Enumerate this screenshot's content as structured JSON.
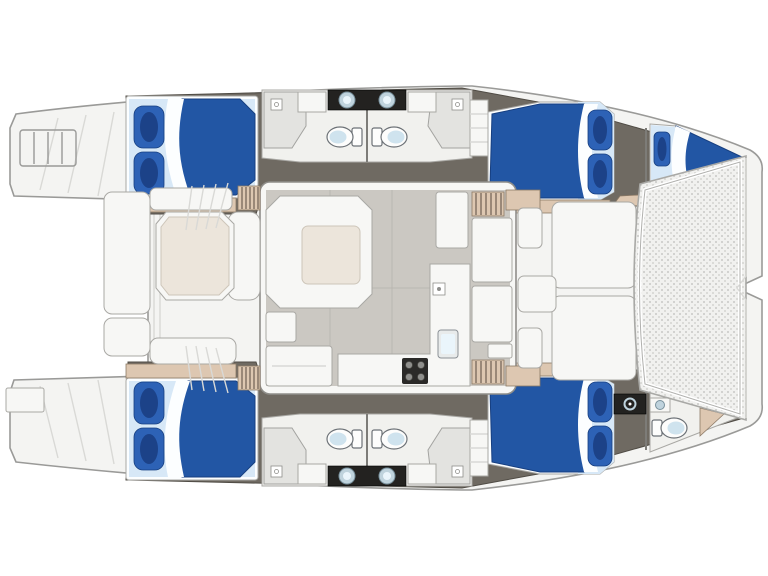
{
  "diagram": {
    "kind": "yacht-deck-plan",
    "subject": "sailing catamaran interior layout, top view, bow to the right",
    "areas": [
      "stern-swim-platforms",
      "aft-cockpit-with-table",
      "salon-with-galley-and-sofa",
      "port-hull-aft-double-cabin",
      "port-hull-bathrooms",
      "port-hull-forward-double-cabin",
      "port-forepeak-berth",
      "starboard-hull-aft-double-cabin",
      "starboard-hull-bathrooms",
      "starboard-hull-forward-double-cabin",
      "starboard-forepeak-head",
      "forward-cockpit",
      "bow-trampoline"
    ]
  },
  "colors": {
    "paper": "#ffffff",
    "deck": "#f4f4f2",
    "deck_line": "#9a9a98",
    "deck_seam": "#d9d9d6",
    "hull_floor": "#6f6a62",
    "hull_floor_dark": "#504c45",
    "tan": "#ddc7b1",
    "tan_line": "#8d7a66",
    "step_stripe": "#6f5f52",
    "salon_floor": "#cbc8c2",
    "salon_seam": "#bab7b1",
    "furniture": "#f7f7f5",
    "furniture_line": "#a9a8a4",
    "table_top": "#ece5db",
    "duvet": "#2256a4",
    "duvet_shadow": "#173f80",
    "mattress": "#d7e8f7",
    "sheet": "#fcfeff",
    "pillow": "#2d62b6",
    "pillow_core": "#1c4288",
    "fixture_line": "#6d7277",
    "toilet_seat": "#cfe3ee",
    "sink_metal": "#bfd3dd",
    "vanity_dark": "#232220",
    "stove_dark": "#2b2a28",
    "burner": "#8f8f8c",
    "shower": "#e3e3e0",
    "tramp_base": "#f1f1ef",
    "tramp_dot": "#c9c9c7"
  }
}
